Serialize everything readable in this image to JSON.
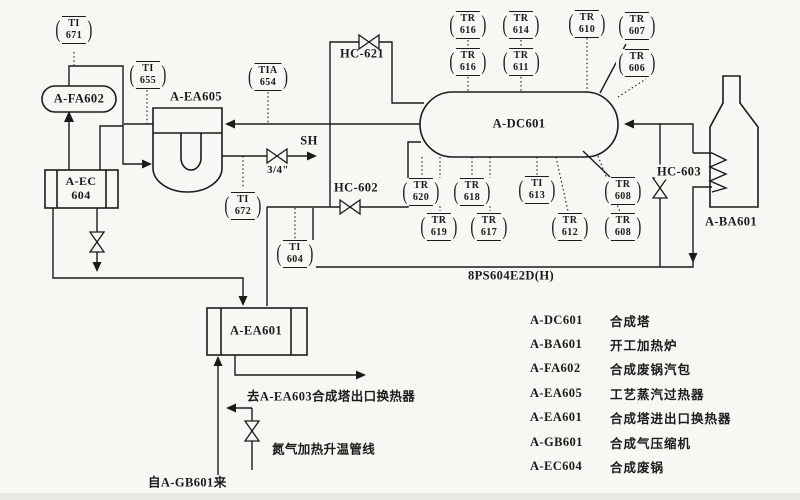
{
  "diagram_title": "synthesis-loop-pid",
  "colors": {
    "line": "#1b1b1b",
    "background": "#f7f7f4"
  },
  "instruments": [
    {
      "tag": "TI",
      "num": "671"
    },
    {
      "tag": "TI",
      "num": "655"
    },
    {
      "tag": "TIA",
      "num": "654"
    },
    {
      "tag": "TI",
      "num": "672"
    },
    {
      "tag": "TI",
      "num": "604"
    },
    {
      "tag": "TR",
      "num": "616"
    },
    {
      "tag": "TR",
      "num": "616"
    },
    {
      "tag": "TR",
      "num": "614"
    },
    {
      "tag": "TR",
      "num": "611"
    },
    {
      "tag": "TR",
      "num": "610"
    },
    {
      "tag": "TR",
      "num": "607"
    },
    {
      "tag": "TR",
      "num": "606"
    },
    {
      "tag": "TR",
      "num": "620"
    },
    {
      "tag": "TR",
      "num": "619"
    },
    {
      "tag": "TR",
      "num": "618"
    },
    {
      "tag": "TR",
      "num": "617"
    },
    {
      "tag": "TI",
      "num": "613"
    },
    {
      "tag": "TR",
      "num": "612"
    },
    {
      "tag": "TR",
      "num": "608"
    },
    {
      "tag": "TR",
      "num": "608"
    }
  ],
  "equipment": {
    "fa602": "A-FA602",
    "ea605": "A-EA605",
    "ec604_l1": "A-EC",
    "ec604_l2": "604",
    "dc601": "A-DC601",
    "ba601": "A-BA601",
    "ea601": "A-EA601"
  },
  "labels": {
    "sh": "SH",
    "valve_size": "3/4\"",
    "hc621": "HC-621",
    "hc602": "HC-602",
    "hc603": "HC-603",
    "line_8ps": "8PS604E2D(H)",
    "to_ea603": "去A-EA603合成塔出口换热器",
    "n2_line": "氮气加热升温管线",
    "from_gb601": "自A-GB601来"
  },
  "legend": {
    "rows": [
      {
        "tag": "A-DC601",
        "desc": "合成塔"
      },
      {
        "tag": "A-BA601",
        "desc": "开工加热炉"
      },
      {
        "tag": "A-FA602",
        "desc": "合成废锅汽包"
      },
      {
        "tag": "A-EA605",
        "desc": "工艺蒸汽过热器"
      },
      {
        "tag": "A-EA601",
        "desc": "合成塔进出口换热器"
      },
      {
        "tag": "A-GB601",
        "desc": "合成气压缩机"
      },
      {
        "tag": "A-EC604",
        "desc": "合成废锅"
      }
    ]
  }
}
